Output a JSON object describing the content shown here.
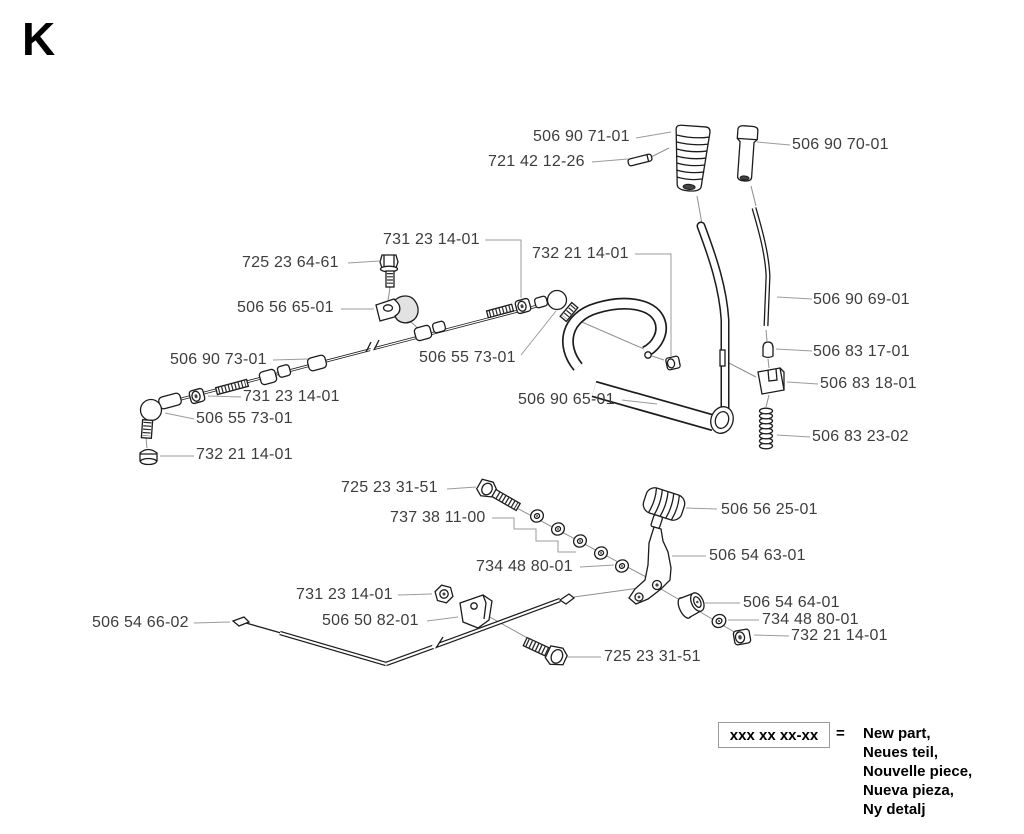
{
  "diagram": {
    "section_letter": "K",
    "callouts": [
      {
        "text": "506 90 71-01",
        "x": 533,
        "y": 130,
        "leader": [
          [
            636,
            138
          ],
          [
            671,
            132
          ]
        ]
      },
      {
        "text": "721 42 12-26",
        "x": 488,
        "y": 155,
        "leader": [
          [
            592,
            162
          ],
          [
            628,
            159
          ]
        ]
      },
      {
        "text": "506 90 70-01",
        "x": 792,
        "y": 138,
        "leader": [
          [
            790,
            145
          ],
          [
            757,
            142
          ]
        ]
      },
      {
        "text": "731 23 14-01",
        "x": 383,
        "y": 233,
        "leader": [
          [
            485,
            240
          ],
          [
            521,
            240
          ],
          [
            521,
            298
          ]
        ]
      },
      {
        "text": "725 23 64-61",
        "x": 242,
        "y": 256,
        "leader": [
          [
            348,
            263
          ],
          [
            379,
            261
          ]
        ]
      },
      {
        "text": "732 21 14-01",
        "x": 532,
        "y": 247,
        "leader": [
          [
            635,
            254
          ],
          [
            671,
            254
          ],
          [
            671,
            356
          ]
        ]
      },
      {
        "text": "506 56 65-01",
        "x": 237,
        "y": 301,
        "leader": [
          [
            341,
            309
          ],
          [
            374,
            309
          ]
        ]
      },
      {
        "text": "506 90 69-01",
        "x": 813,
        "y": 293,
        "leader": [
          [
            812,
            299
          ],
          [
            777,
            297
          ]
        ]
      },
      {
        "text": "506 90 73-01",
        "x": 170,
        "y": 353,
        "leader": [
          [
            273,
            360
          ],
          [
            308,
            359
          ]
        ]
      },
      {
        "text": "506 55 73-01",
        "x": 419,
        "y": 351,
        "leader": [
          [
            521,
            355
          ],
          [
            556,
            311
          ]
        ]
      },
      {
        "text": "506 83 17-01",
        "x": 813,
        "y": 345,
        "leader": [
          [
            812,
            351
          ],
          [
            776,
            349
          ]
        ]
      },
      {
        "text": "506 83 18-01",
        "x": 820,
        "y": 377,
        "leader": [
          [
            818,
            384
          ],
          [
            787,
            382
          ]
        ]
      },
      {
        "text": "731 23 14-01",
        "x": 243,
        "y": 390,
        "leader": [
          [
            241,
            397
          ],
          [
            208,
            396
          ]
        ]
      },
      {
        "text": "506 55 73-01",
        "x": 196,
        "y": 412,
        "leader": [
          [
            194,
            419
          ],
          [
            165,
            413
          ]
        ]
      },
      {
        "text": "506 90 65-01",
        "x": 518,
        "y": 393,
        "leader": [
          [
            622,
            400
          ],
          [
            657,
            404
          ]
        ]
      },
      {
        "text": "732 21 14-01",
        "x": 196,
        "y": 448,
        "leader": [
          [
            194,
            456
          ],
          [
            160,
            456
          ]
        ]
      },
      {
        "text": "506 83 23-02",
        "x": 812,
        "y": 430,
        "leader": [
          [
            810,
            437
          ],
          [
            777,
            435
          ]
        ]
      },
      {
        "text": "725 23 31-51",
        "x": 341,
        "y": 481,
        "leader": [
          [
            447,
            489
          ],
          [
            476,
            487
          ]
        ]
      },
      {
        "text": "737 38 11-00",
        "x": 390,
        "y": 511,
        "leader": [
          [
            492,
            518
          ],
          [
            514,
            518
          ],
          [
            514,
            529
          ],
          [
            536,
            529
          ],
          [
            536,
            541
          ],
          [
            558,
            541
          ],
          [
            558,
            552
          ],
          [
            576,
            552
          ]
        ]
      },
      {
        "text": "734 48 80-01",
        "x": 476,
        "y": 560,
        "leader": [
          [
            580,
            567
          ],
          [
            614,
            565
          ]
        ]
      },
      {
        "text": "506 56 25-01",
        "x": 721,
        "y": 503,
        "leader": [
          [
            717,
            509
          ],
          [
            686,
            508
          ]
        ]
      },
      {
        "text": "506 54 63-01",
        "x": 709,
        "y": 549,
        "leader": [
          [
            706,
            556
          ],
          [
            672,
            556
          ]
        ]
      },
      {
        "text": "731 23 14-01",
        "x": 296,
        "y": 588,
        "leader": [
          [
            398,
            595
          ],
          [
            432,
            594
          ]
        ]
      },
      {
        "text": "506 54 66-02",
        "x": 92,
        "y": 616,
        "leader": [
          [
            194,
            623
          ],
          [
            230,
            622
          ]
        ]
      },
      {
        "text": "506 50 82-01",
        "x": 322,
        "y": 614,
        "leader": [
          [
            427,
            621
          ],
          [
            458,
            617
          ]
        ]
      },
      {
        "text": "506 54 64-01",
        "x": 743,
        "y": 596,
        "leader": [
          [
            740,
            603
          ],
          [
            704,
            603
          ]
        ]
      },
      {
        "text": "734 48 80-01",
        "x": 762,
        "y": 613,
        "leader": [
          [
            759,
            620
          ],
          [
            728,
            620
          ]
        ]
      },
      {
        "text": "732 21 14-01",
        "x": 791,
        "y": 629,
        "leader": [
          [
            789,
            636
          ],
          [
            754,
            635
          ]
        ]
      },
      {
        "text": "725 23 31-51",
        "x": 604,
        "y": 650,
        "leader": [
          [
            601,
            657
          ],
          [
            567,
            657
          ]
        ]
      }
    ]
  },
  "legend": {
    "pattern": "xxx xx xx-xx",
    "equals_sign": "=",
    "lines": [
      "New part,",
      "Neues teil,",
      "Nouvelle piece,",
      "Nueva pieza,",
      "Ny detalj"
    ]
  }
}
